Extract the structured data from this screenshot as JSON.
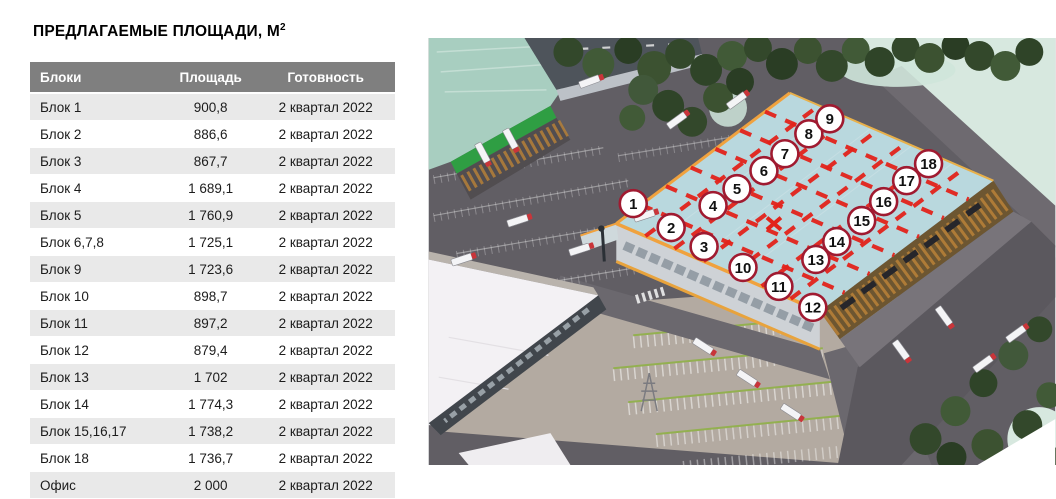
{
  "title": {
    "text": "ПРЕДЛАГАЕМЫЕ ПЛОЩАДИ, М",
    "sup": "2"
  },
  "table": {
    "columns": [
      "Блоки",
      "Площадь",
      "Готовность"
    ],
    "rows": [
      [
        "Блок 1",
        "900,8",
        "2 квартал 2022"
      ],
      [
        "Блок 2",
        "886,6",
        "2 квартал 2022"
      ],
      [
        "Блок 3",
        "867,7",
        "2 квартал 2022"
      ],
      [
        "Блок 4",
        "1 689,1",
        "2 квартал 2022"
      ],
      [
        "Блок 5",
        "1 760,9",
        "2 квартал 2022"
      ],
      [
        "Блок 6,7,8",
        "1 725,1",
        "2 квартал 2022"
      ],
      [
        "Блок 9",
        "1 723,6",
        "2 квартал 2022"
      ],
      [
        "Блок 10",
        "898,7",
        "2 квартал 2022"
      ],
      [
        "Блок 11",
        "897,2",
        "2 квартал 2022"
      ],
      [
        "Блок 12",
        "879,4",
        "2 квартал 2022"
      ],
      [
        "Блок 13",
        "1 702",
        "2 квартал 2022"
      ],
      [
        "Блок 14",
        "1 774,3",
        "2 квартал 2022"
      ],
      [
        "Блок 15,16,17",
        "1 738,2",
        "2 квартал 2022"
      ],
      [
        "Блок 18",
        "1 736,7",
        "2 квартал 2022"
      ],
      [
        "Офис",
        "2 000",
        "2 квартал 2022"
      ]
    ],
    "colors": {
      "header_bg": "#7f7f7f",
      "row_alt_bg": "#e9e9e9"
    }
  },
  "plan": {
    "markers": [
      {
        "n": "1",
        "x": 205,
        "y": 166
      },
      {
        "n": "2",
        "x": 243,
        "y": 190
      },
      {
        "n": "3",
        "x": 276,
        "y": 209
      },
      {
        "n": "4",
        "x": 285,
        "y": 168
      },
      {
        "n": "5",
        "x": 309,
        "y": 151
      },
      {
        "n": "6",
        "x": 336,
        "y": 133
      },
      {
        "n": "7",
        "x": 357,
        "y": 116
      },
      {
        "n": "8",
        "x": 381,
        "y": 96
      },
      {
        "n": "9",
        "x": 402,
        "y": 81
      },
      {
        "n": "10",
        "x": 315,
        "y": 230
      },
      {
        "n": "11",
        "x": 351,
        "y": 249
      },
      {
        "n": "12",
        "x": 385,
        "y": 270
      },
      {
        "n": "13",
        "x": 388,
        "y": 222
      },
      {
        "n": "14",
        "x": 409,
        "y": 204
      },
      {
        "n": "15",
        "x": 434,
        "y": 183
      },
      {
        "n": "16",
        "x": 456,
        "y": 164
      },
      {
        "n": "17",
        "x": 479,
        "y": 143
      },
      {
        "n": "18",
        "x": 501,
        "y": 126
      }
    ],
    "colors": {
      "marker_fill": "#ffffff",
      "marker_border": "#a01a30",
      "marker_number": "#111111",
      "divider_red": "#e2231a",
      "roof_blue": "#b9d8de",
      "trim_orange": "#f0a23e",
      "neighbor_green": "#2f9e43"
    }
  }
}
